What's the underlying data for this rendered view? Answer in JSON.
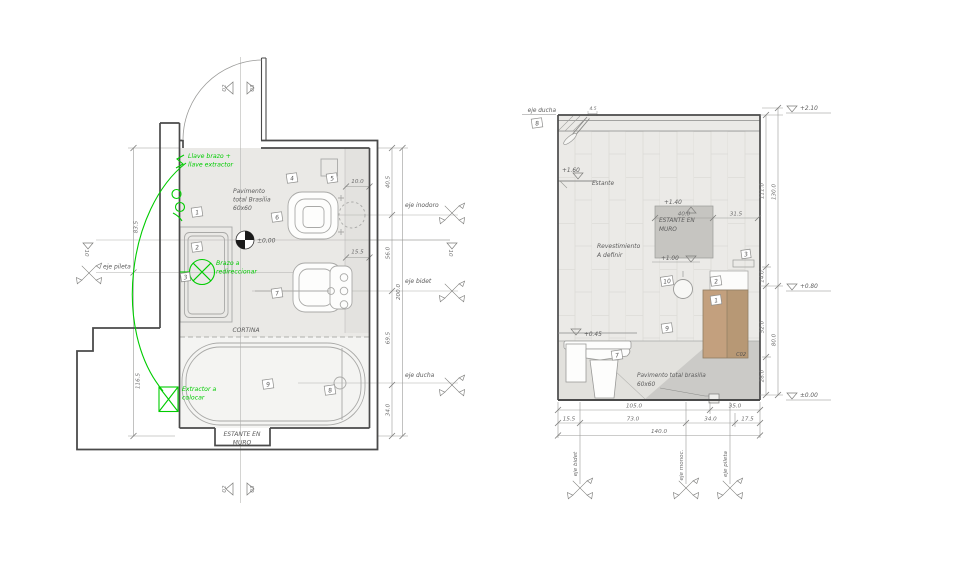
{
  "colors": {
    "annotation_green": "#00cc00",
    "wood": "#c3a07e",
    "wood_dark": "#b79875",
    "shelf_gray": "#c6c5c1",
    "wall_line": "#4a4a4a",
    "tile_fill": "#ebeae7"
  },
  "plan": {
    "green_notes": {
      "llave_1": "Llave brazo +",
      "llave_2": "llave extractor",
      "brazo_1": "Brazo a",
      "brazo_2": "redireccionar",
      "extractor_1": "Extractor a",
      "extractor_2": "colocar"
    },
    "texts": {
      "pavimento_1": "Pavimento",
      "pavimento_2": "total Brasilia",
      "pavimento_3": "60x60",
      "cortina": "CORTINA",
      "estante_1": "ESTANTE EN",
      "estante_2": "MURO",
      "level_zero": "±0,00"
    },
    "axes": {
      "pileta": "eje pileta",
      "inodoro": "eje inodoro",
      "bidet": "eje bidet",
      "ducha": "eje ducha"
    },
    "dims": {
      "left_top": "83.5",
      "left_bottom": "116.5",
      "right_1": "40.5",
      "right_2": "56.0",
      "right_3": "69.5",
      "right_4": "34.0",
      "right_total": "200.0",
      "niche": "10.0",
      "bidet_offset": "15.5"
    },
    "section": {
      "top_left": "02",
      "top_right": "03",
      "bottom_left": "02",
      "bottom_right": "03",
      "datum_left": "10",
      "datum_right": "10"
    },
    "tags": {
      "t1": "1",
      "t2": "2",
      "t3": "3",
      "t4": "4",
      "t5": "5",
      "t6": "6",
      "t7": "7",
      "t8": "8",
      "t9": "9"
    }
  },
  "elevation": {
    "texts": {
      "eje_ducha": "eje ducha",
      "estante": "Estante",
      "revestimiento_1": "Revestimiento",
      "revestimiento_2": "A definir",
      "estante_muro_1": "ESTANTE EN",
      "estante_muro_2": "MURO",
      "pavimento_1": "Pavimento total brasilia",
      "pavimento_2": "60x60",
      "cabinet_code": "C02"
    },
    "levels": {
      "l210": "+2.10",
      "l160": "+1.60",
      "l140": "+1.40",
      "l100": "+1.00",
      "l080": "+0.80",
      "l045": "+0.45",
      "l000": "±0.00"
    },
    "dims": {
      "shelf_w": "40.0",
      "shelf_gap": "31.5",
      "shower_off": "4.5",
      "b105": "105.0",
      "b35": "35.0",
      "b155": "15.5",
      "b73": "73.0",
      "b34": "34.0",
      "b175": "17.5",
      "b140": "140.0",
      "r111": "111.0",
      "r130": "130.0",
      "r14": "14.0",
      "r52": "52.0",
      "r80": "80.0",
      "r28": "28.0"
    },
    "axes": {
      "bidet": "eje bidet",
      "monoc": "eje monoc.",
      "pileta": "eje pileta"
    },
    "tags": {
      "t1": "1",
      "t2": "2",
      "t3": "3",
      "t7": "7",
      "t8": "8",
      "t9": "9",
      "t10": "10"
    }
  }
}
